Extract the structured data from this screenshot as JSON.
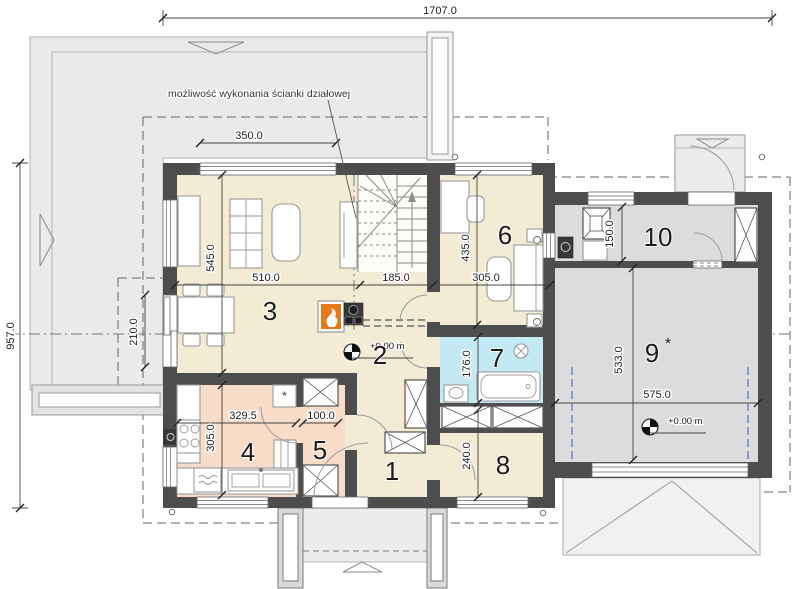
{
  "annotation": {
    "text": "możliwość wykonania ścianki działowej"
  },
  "levels": {
    "living": "+0.00 m",
    "garage": "+0.00 m"
  },
  "rooms": {
    "r1": "1",
    "r2": "2",
    "r3": "3",
    "r4": "4",
    "r5": "5",
    "r6": "6",
    "r7": "7",
    "r8": "8",
    "r9": "9",
    "r9_suffix": "*",
    "r10": "10"
  },
  "dims": {
    "total_width": "1707.0",
    "total_depth": "957.0",
    "living_window": "350.0",
    "living_depth": "545.0",
    "living_width": "510.0",
    "hall_width": "185.0",
    "bedroom_width": "305.0",
    "bedroom_depth": "435.0",
    "utility_depth": "150.0",
    "garage_depth": "533.0",
    "garage_width": "575.0",
    "terrace_door": "210.0",
    "kitchen_width": "329.5",
    "kitchen_depth": "305.0",
    "pantry_width": "100.0",
    "bath_depth": "176.0",
    "room8_depth": "240.0"
  },
  "symbols": {
    "freezer": "*"
  },
  "colors": {
    "wall": "#4d4d4d",
    "floor_main": "#f1ecd3",
    "floor_kitchen": "#f8dcc8",
    "floor_bath": "#c3e9f2",
    "floor_garage": "#dcdcdc",
    "roof": "#eaeaea",
    "fireplace_orange": "#e8791b",
    "garage_rail_blue": "#5b76e8"
  }
}
